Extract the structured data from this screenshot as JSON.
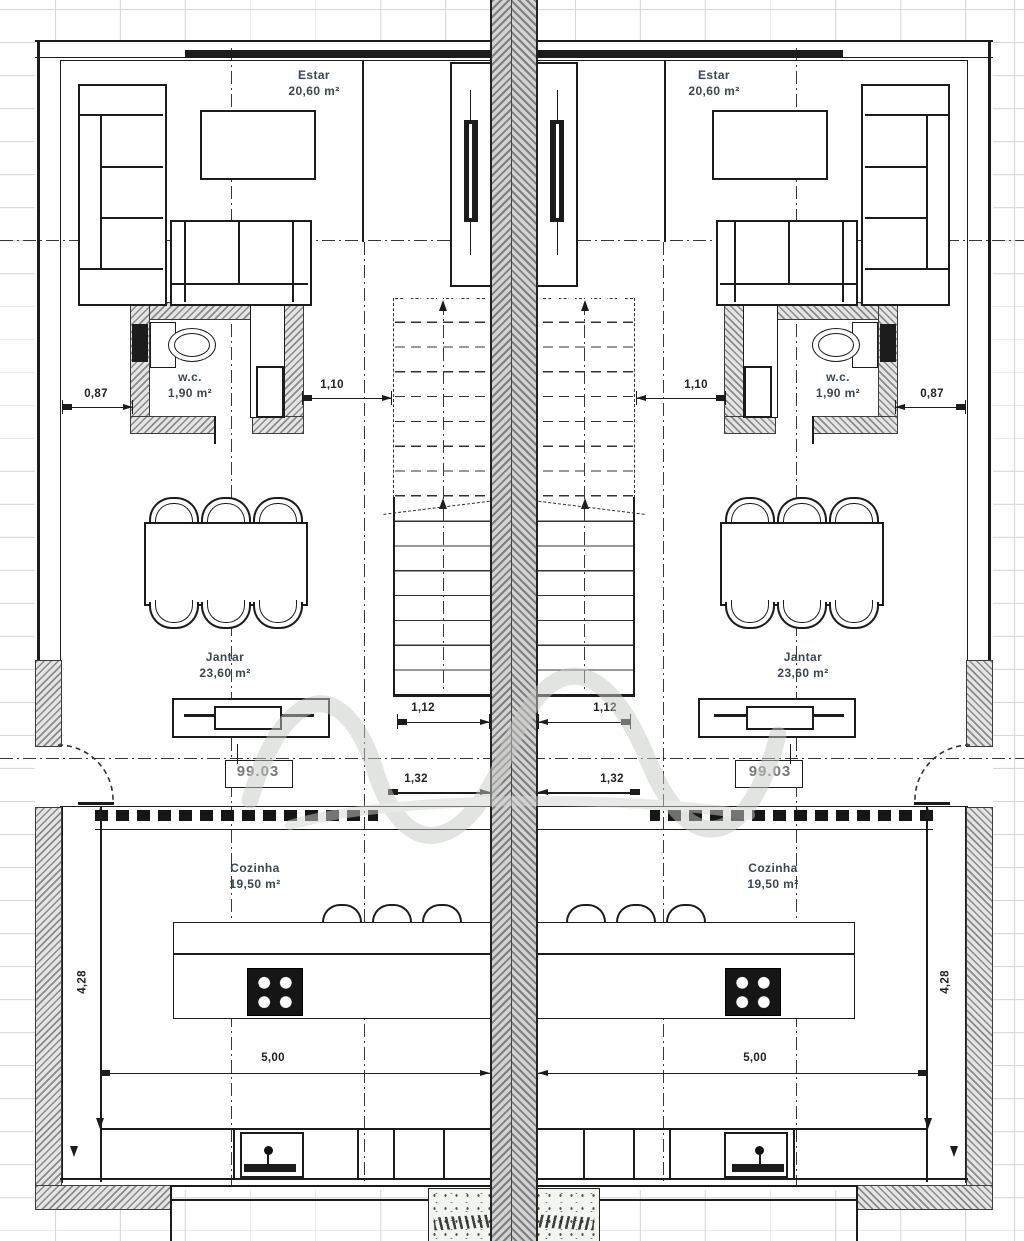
{
  "plan": {
    "rooms": {
      "estar": {
        "name": "Estar",
        "area": "20,60 m²"
      },
      "wc": {
        "name": "w.c.",
        "area": "1,90 m²"
      },
      "jantar": {
        "name": "Jantar",
        "area": "23,60 m²"
      },
      "cozinha": {
        "name": "Cozinha",
        "area": "19,50 m²"
      }
    },
    "level_marker": "99.03",
    "dimensions": {
      "wall_to_wc": "0,87",
      "wc_to_stair": "1,10",
      "stair_width": "1,12",
      "hall_width": "1,32",
      "kitchen_width": "5,00",
      "kitchen_depth": "4,28"
    }
  },
  "colors": {
    "ink": "#1c1c1c",
    "label": "#3b4754",
    "grid": "#d8d8d8",
    "hatchd": "#8a8a8a",
    "hatchl": "#e4e4e4",
    "lvl": "#787878"
  }
}
